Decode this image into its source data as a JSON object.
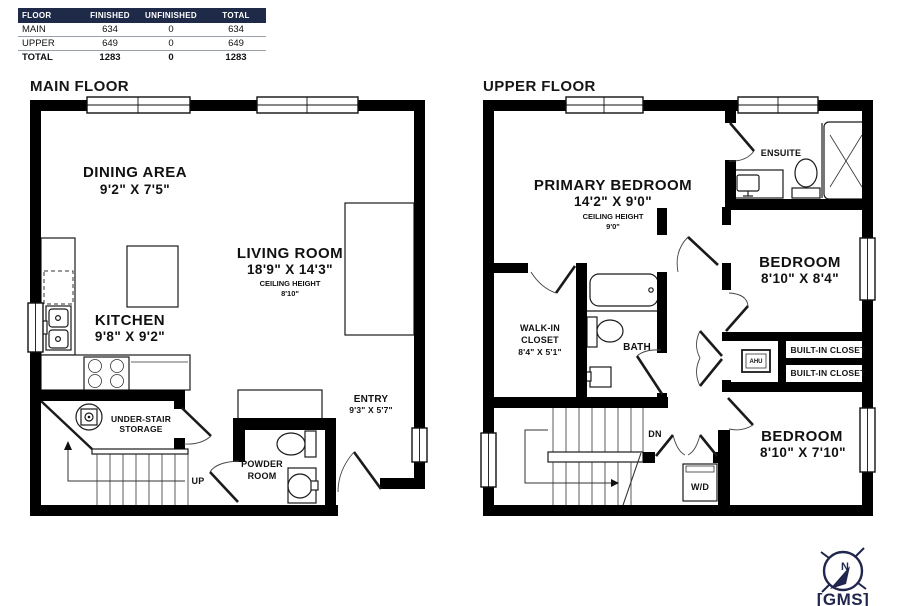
{
  "table": {
    "headers": [
      "FLOOR",
      "FINISHED",
      "UNFINISHED",
      "TOTAL"
    ],
    "rows": [
      [
        "MAIN",
        "634",
        "0",
        "634"
      ],
      [
        "UPPER",
        "649",
        "0",
        "649"
      ],
      [
        "TOTAL",
        "1283",
        "0",
        "1283"
      ]
    ]
  },
  "main_floor": {
    "title": "MAIN FLOOR",
    "dining_name": "DINING AREA",
    "dining_dims": "9'2\" X 7'5\"",
    "living_name": "LIVING ROOM",
    "living_dims": "18'9\" X 14'3\"",
    "ceiling_label": "CEILING HEIGHT",
    "living_ceiling": "8'10\"",
    "kitchen_name": "KITCHEN",
    "kitchen_dims": "9'8\" X 9'2\"",
    "storage_line1": "UNDER-STAIR",
    "storage_line2": "STORAGE",
    "up_label": "UP",
    "powder_line1": "POWDER",
    "powder_line2": "ROOM",
    "entry_name": "ENTRY",
    "entry_dims": "9'3\" X 5'7\""
  },
  "upper_floor": {
    "title": "UPPER FLOOR",
    "primary_name": "PRIMARY BEDROOM",
    "primary_dims": "14'2\" X 9'0\"",
    "ceiling_label": "CEILING HEIGHT",
    "primary_ceiling": "9'0\"",
    "ensuite_name": "ENSUITE",
    "bedroom2_name": "BEDROOM",
    "bedroom2_dims": "8'10\" X 8'4\"",
    "walkin_line1": "WALK-IN",
    "walkin_line2": "CLOSET",
    "walkin_dims": "8'4\" X 5'1\"",
    "bath_name": "BATH",
    "closet1_name": "BUILT-IN CLOSET",
    "closet2_name": "BUILT-IN CLOSET",
    "ahu_name": "AHU",
    "dn_label": "DN",
    "wd_name": "W/D",
    "bedroom3_name": "BEDROOM",
    "bedroom3_dims": "8'10\" X 7'10\""
  },
  "logo": {
    "text": "[GMS]",
    "north": "N"
  }
}
